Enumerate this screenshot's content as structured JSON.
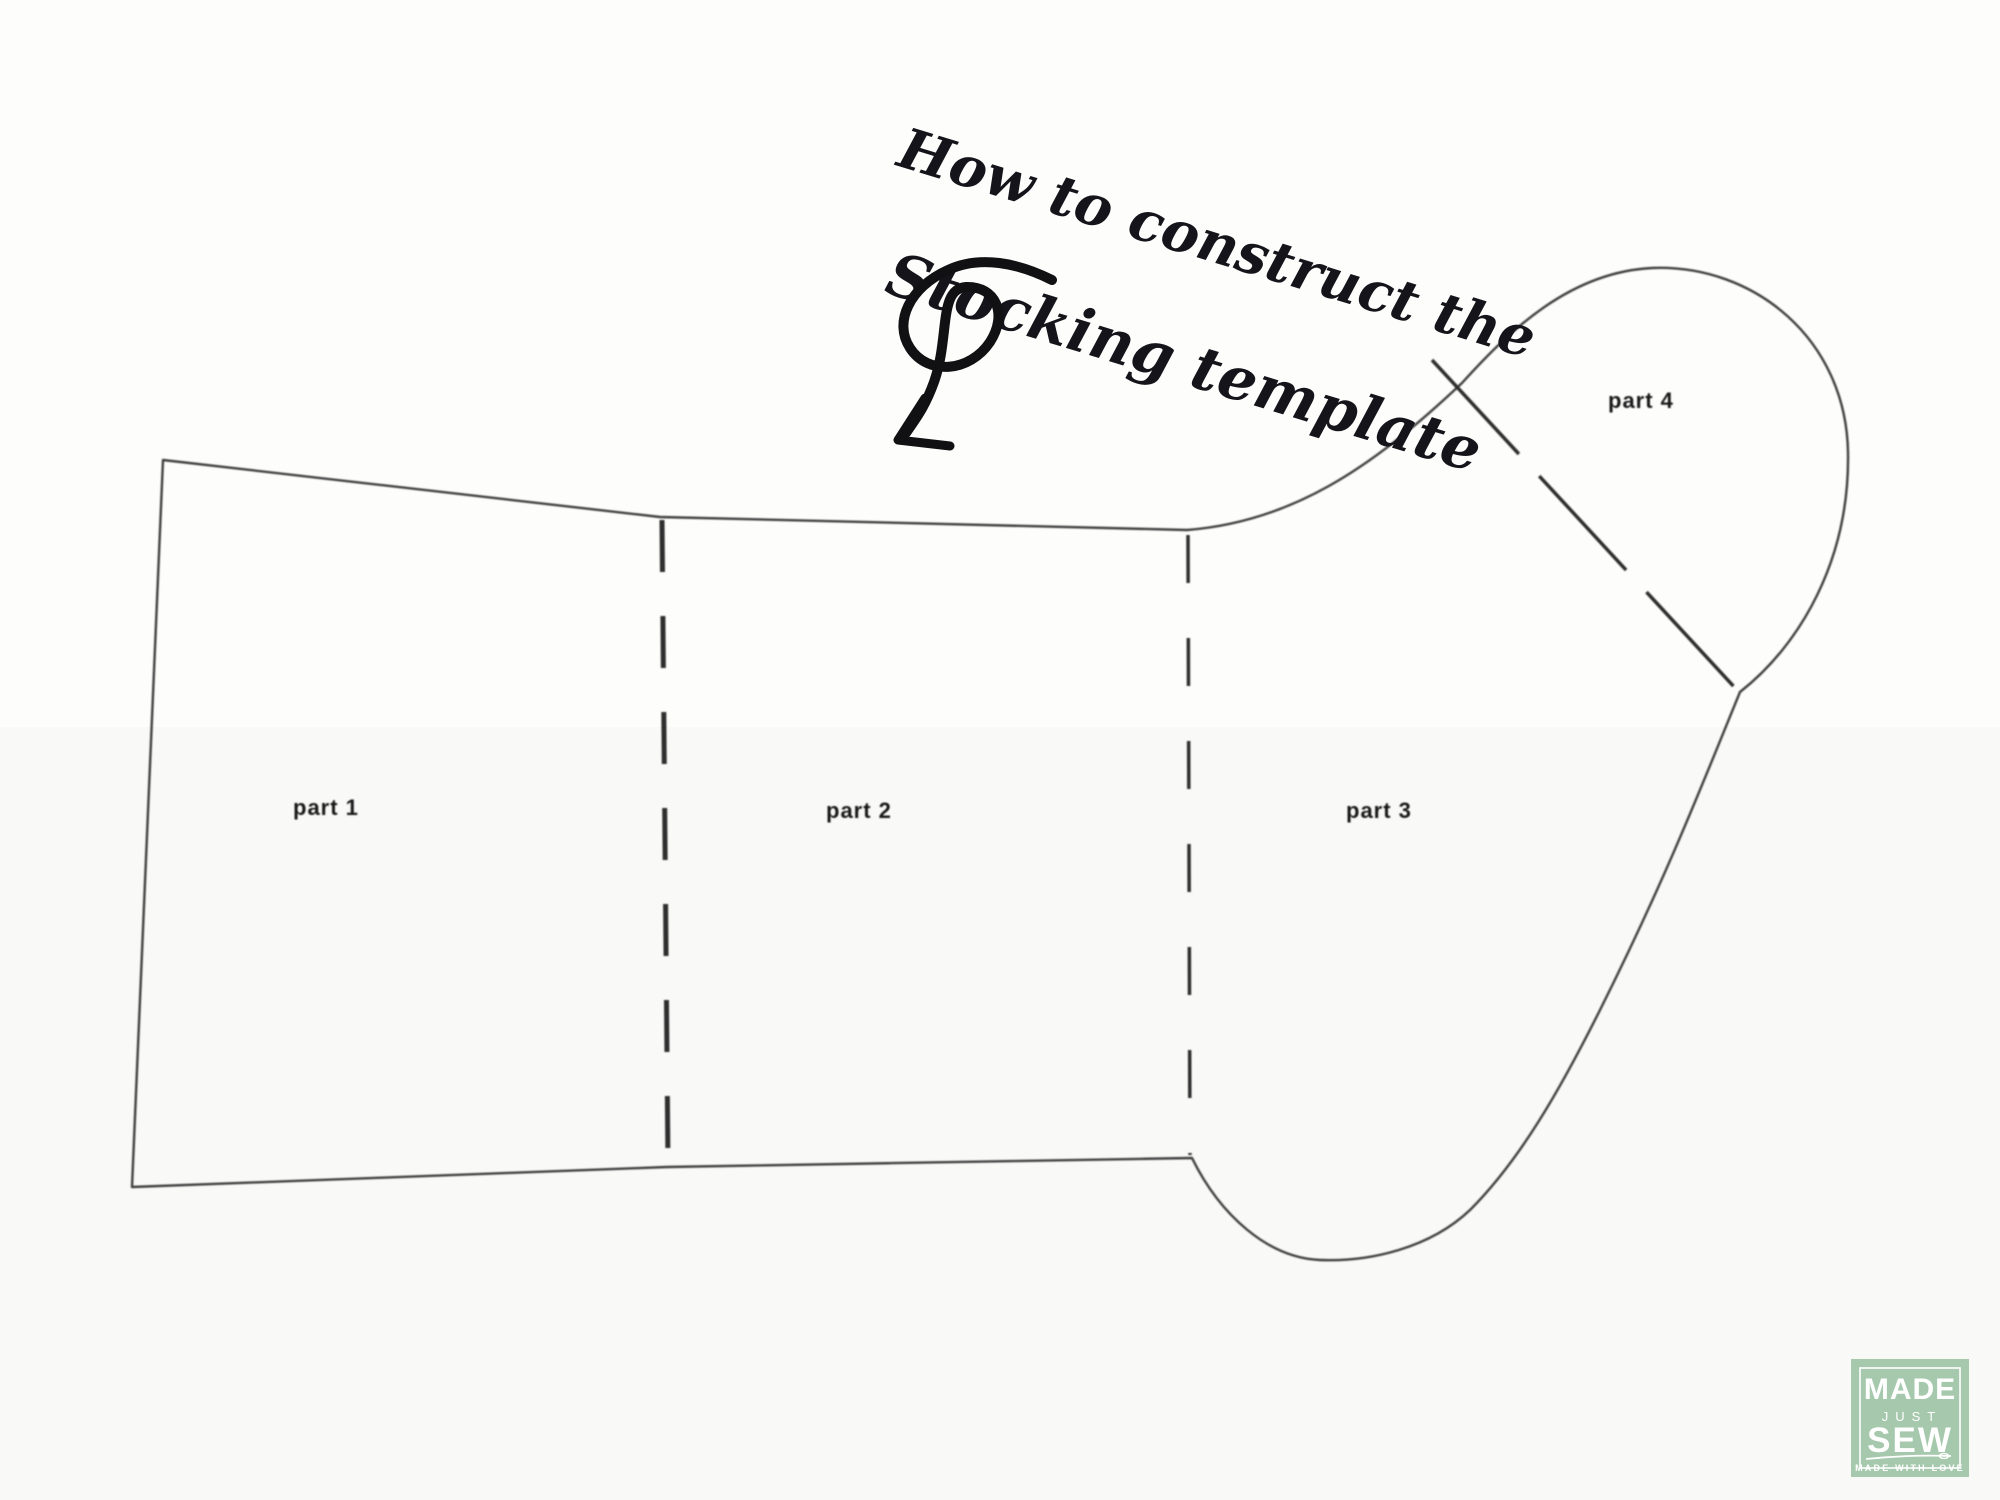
{
  "title": {
    "line1": "How to construct the",
    "line2": "Stocking template"
  },
  "diagram": {
    "part_labels": {
      "part1": "part 1",
      "part2": "part 2",
      "part3": "part 3",
      "part4": "part 4"
    }
  },
  "logo": {
    "word1": "MADE",
    "word2": "JUST",
    "word3": "SEW",
    "tagline": "MADE WITH LOVE",
    "bg_color": "#a6c9ae",
    "text_color": "#ffffff"
  },
  "colors": {
    "outline": "#3f3f3f",
    "title_ink": "#14141a",
    "background": "#fdfdfc"
  }
}
